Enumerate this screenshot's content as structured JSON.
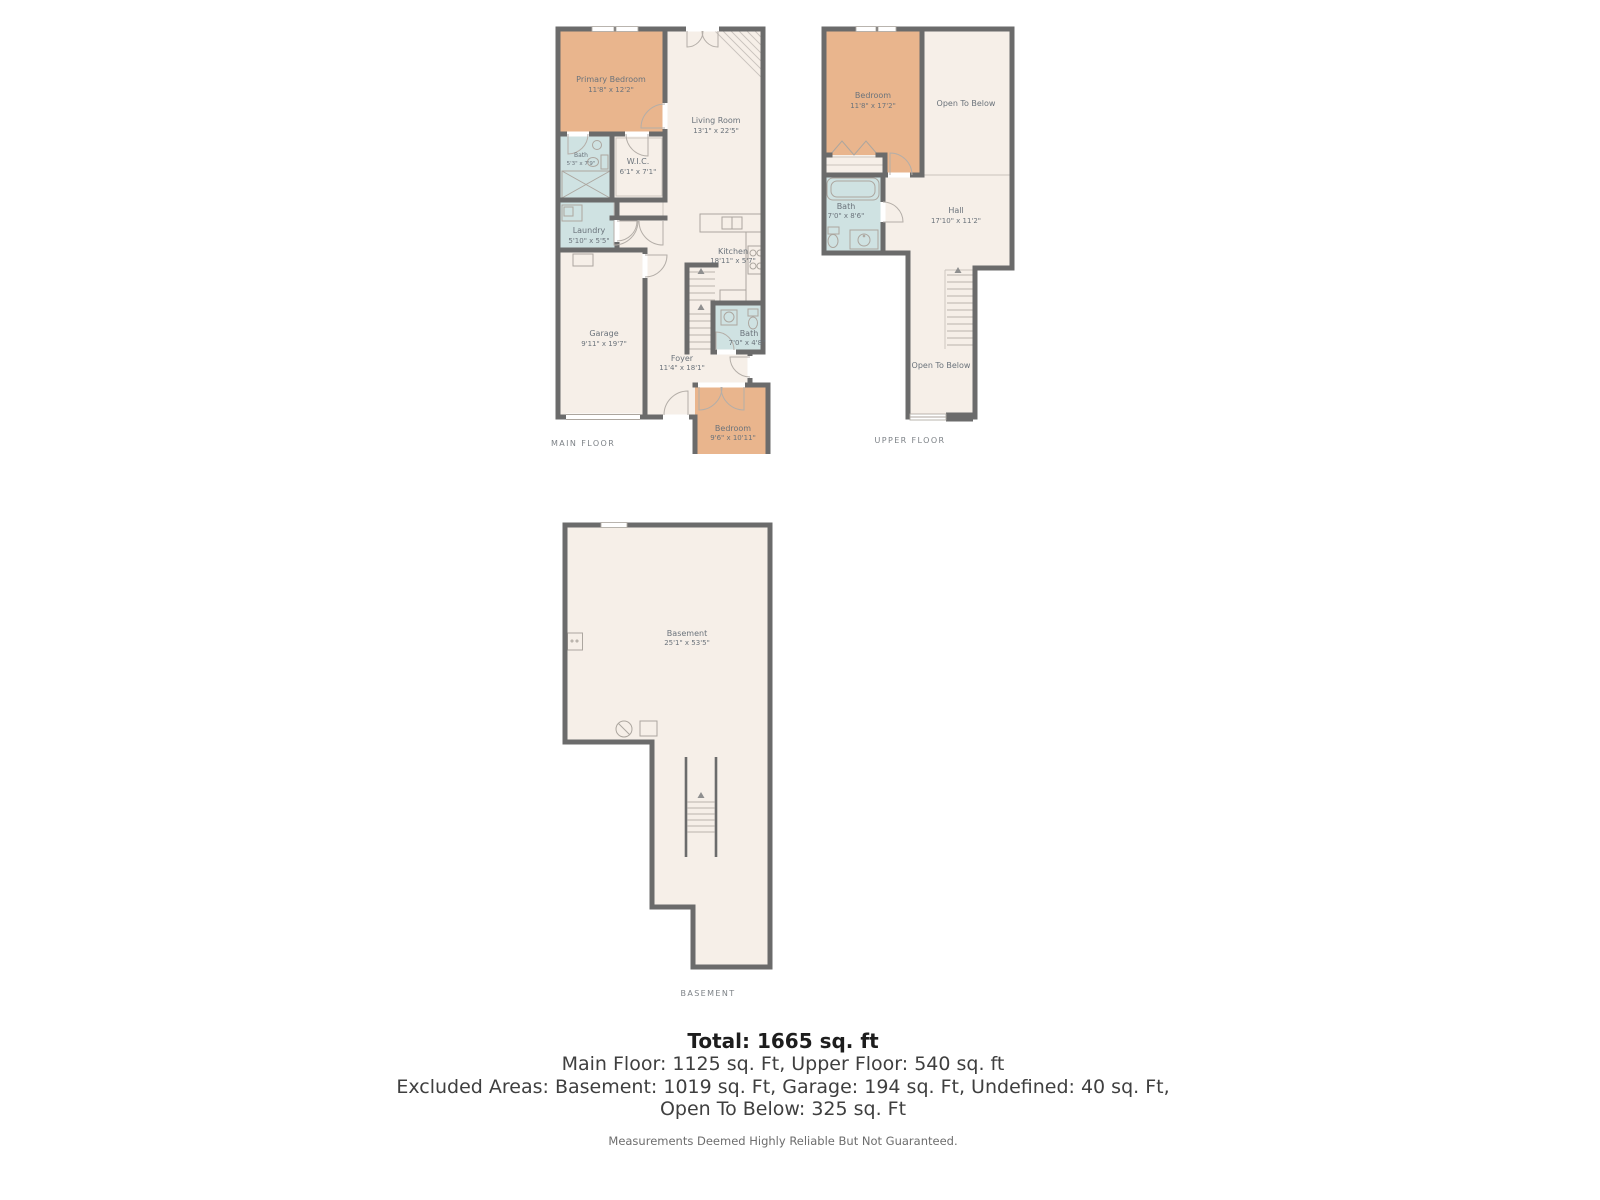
{
  "colors": {
    "wall": "#6b6b6b",
    "floor": "#f6efe8",
    "bedroom": "#e9b58d",
    "bath": "#cfe2e2"
  },
  "floors": {
    "main": {
      "caption": "MAIN FLOOR",
      "rooms": {
        "primary_bedroom": {
          "name": "Primary Bedroom",
          "dims": "11'8\" x 12'2\""
        },
        "living_room": {
          "name": "Living Room",
          "dims": "13'1\" x 22'5\""
        },
        "bath": {
          "name": "Bath",
          "dims": "5'3\" x 7'9\""
        },
        "wic": {
          "name": "W.I.C.",
          "dims": "6'1\" x 7'1\""
        },
        "laundry": {
          "name": "Laundry",
          "dims": "5'10\" x 5'5\""
        },
        "garage": {
          "name": "Garage",
          "dims": "9'11\" x 19'7\""
        },
        "kitchen": {
          "name": "Kitchen",
          "dims": "18'11\" x 5'7\""
        },
        "bath2": {
          "name": "Bath",
          "dims": "7'0\" x 4'8\""
        },
        "foyer": {
          "name": "Foyer",
          "dims": "11'4\" x 18'1\""
        },
        "bedroom": {
          "name": "Bedroom",
          "dims": "9'6\" x 10'11\""
        }
      }
    },
    "upper": {
      "caption": "UPPER FLOOR",
      "rooms": {
        "bedroom": {
          "name": "Bedroom",
          "dims": "11'8\" x 17'2\""
        },
        "open_to_below_top": {
          "name": "Open To Below"
        },
        "bath": {
          "name": "Bath",
          "dims": "7'0\" x 8'6\""
        },
        "hall": {
          "name": "Hall",
          "dims": "17'10\" x 11'2\""
        },
        "open_to_below_stairs": {
          "name": "Open To Below"
        }
      }
    },
    "basement": {
      "caption": "BASEMENT",
      "rooms": {
        "basement": {
          "name": "Basement",
          "dims": "25'1\" x 53'5\""
        }
      }
    }
  },
  "summary": {
    "total": "Total: 1665 sq. ft",
    "line1": "Main Floor: 1125 sq. Ft, Upper Floor: 540 sq. ft",
    "line2": "Excluded Areas: Basement: 1019 sq. Ft, Garage: 194 sq. Ft, Undefined: 40 sq. Ft,",
    "line3": "Open To Below: 325 sq. Ft",
    "disclaimer": "Measurements Deemed Highly Reliable But Not Guaranteed."
  }
}
